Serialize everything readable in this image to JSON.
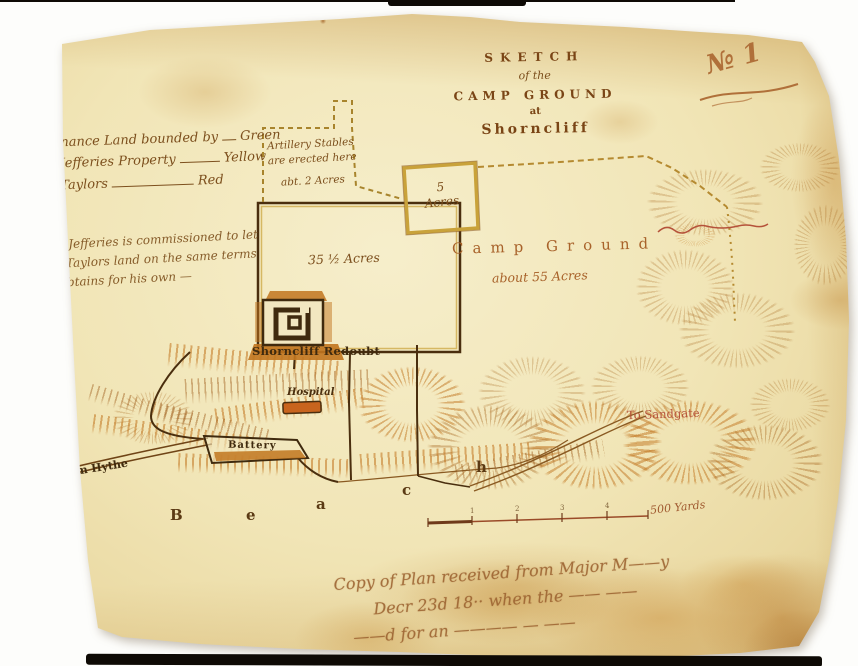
{
  "colors": {
    "paper": "#f0e3b2",
    "ink": "#5b3a14",
    "red_ink": "#b5523a",
    "boundary_yellow": "#c9a23a",
    "hatch_tan": "#a96a23"
  },
  "plate_number": "№ 1",
  "title": {
    "l1": "SKETCH",
    "l2": "of the",
    "l3": "CAMP GROUND",
    "l4": "at",
    "l5": "Shorncliff"
  },
  "legend": {
    "rows": [
      {
        "label": "Ordnance Land bounded by",
        "value": "Green"
      },
      {
        "label": "Mr Jefferies Property",
        "value": "Yellow"
      },
      {
        "label": "Mr Taylors",
        "value": "Red"
      }
    ]
  },
  "note": {
    "l1": "\" Mr Jefferies is commissioned to let",
    "l2": "Mr Taylors land on the same terms",
    "l3": "he obtains for his own —"
  },
  "areas": {
    "stables": {
      "l1": "Artillery Stables",
      "l2": "are erected here",
      "l3": "abt. 2 Acres"
    },
    "five_acres": {
      "l1": "5",
      "l2": "Acres"
    },
    "plot": "35 ½ Acres",
    "camp": {
      "l1": "Camp Ground",
      "l2": "about 55 Acres"
    }
  },
  "features": {
    "redoubt": "Shorncliff Redoubt",
    "hospital": "Hospital",
    "battery": "Battery",
    "road_west": "from Hythe",
    "road_east": "To Sandgate",
    "beach": [
      "B",
      "e",
      "a",
      "c",
      "h"
    ]
  },
  "scale_bar": {
    "tick_labels": [
      "1",
      "2",
      "3",
      "4"
    ],
    "unit_label": "500 Yards"
  },
  "inscription": {
    "l1": "Copy of Plan received from Major M——y",
    "l2": "Decr 23d 18·· when the —— ——",
    "l3": "——d for an ———— — ——"
  },
  "icons": {
    "redoubt": "fort-plan-icon",
    "hospital": "building-icon",
    "battery": "earthwork-battery-icon"
  }
}
